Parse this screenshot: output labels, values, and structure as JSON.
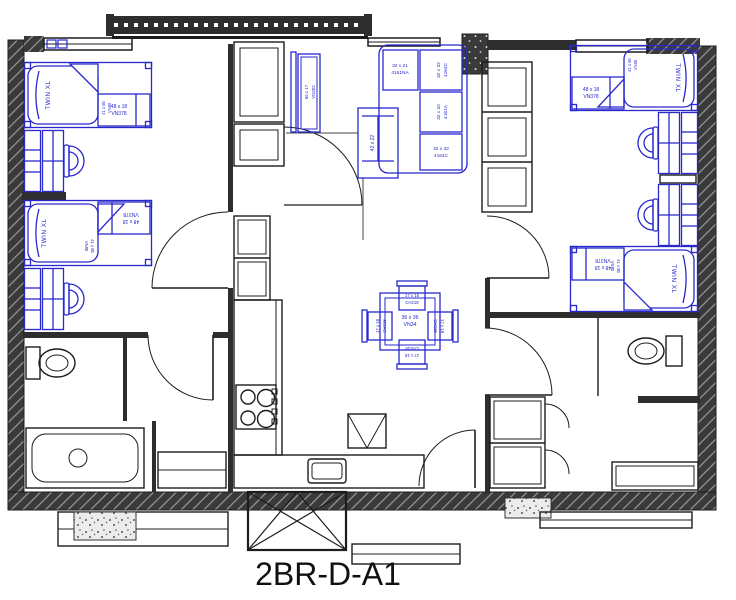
{
  "title": "2BR-D-A1",
  "colors": {
    "furniture_blue": "#2828cc",
    "wall_dark": "#2e2e2e"
  },
  "labels": {
    "bed": {
      "name": "TWIN XL",
      "size": "41 x 80",
      "model": "VN80"
    },
    "desk": {
      "size": "48 x 18",
      "model": "VN378"
    },
    "sofa_sections": [
      {
        "size": "32 x 21",
        "model": "4161NA"
      },
      {
        "size": "32 x 32",
        "model": "4164C"
      },
      {
        "size": "32 x 32",
        "model": "4161A"
      },
      {
        "size": "32 x 32",
        "model": "4164C"
      }
    ],
    "media_console": {
      "size": "56 x 17",
      "model": "VN202"
    },
    "coffee_table": {
      "size": "42 x 22"
    },
    "dining_table": {
      "size": "36 x 36",
      "model": "VN34"
    },
    "dining_chair": {
      "size": "17 x 18",
      "model": "CH218"
    }
  }
}
